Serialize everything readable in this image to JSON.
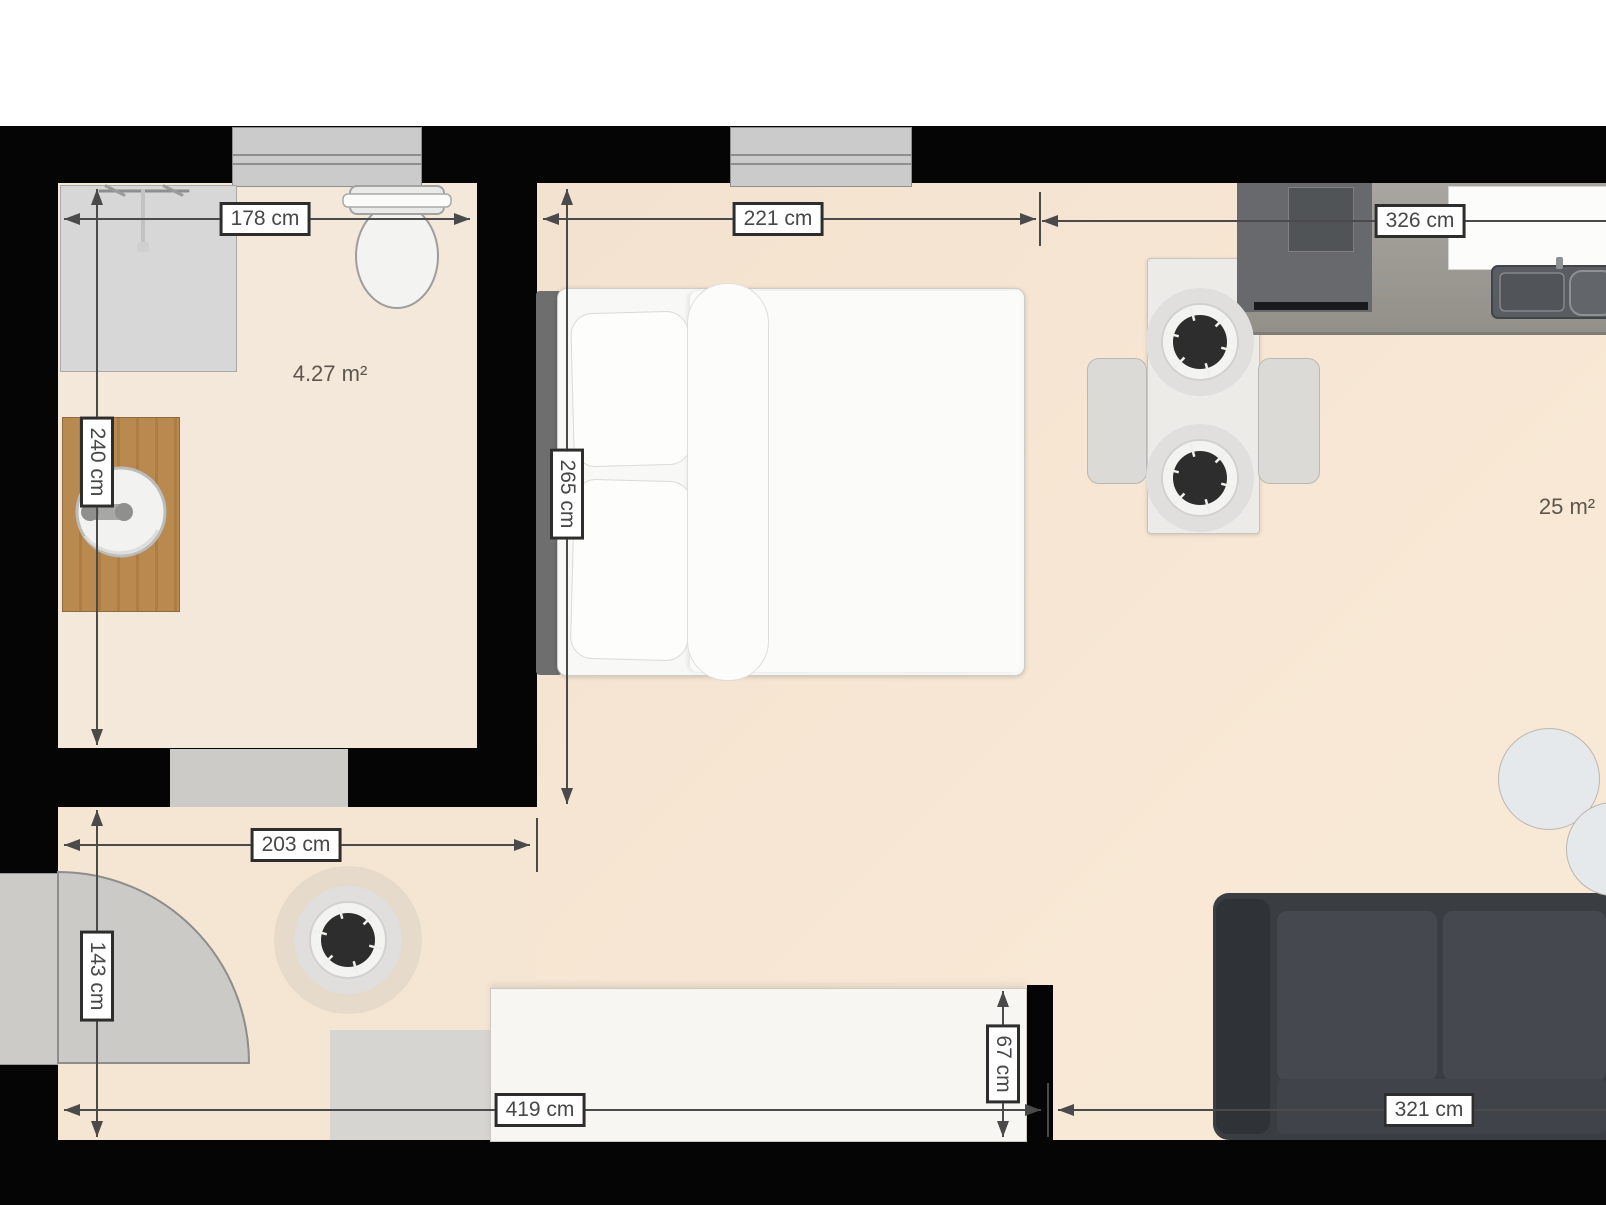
{
  "title": "Studio apartment floor plan",
  "rooms": {
    "bathroom_area": "4.27 m²",
    "main_area": "25 m²"
  },
  "dimensions": {
    "bath_width": "178 cm",
    "bed_zone_width": "221 cm",
    "kitchen_run_width": "326 cm",
    "bath_depth": "240 cm",
    "bed_zone_depth": "265 cm",
    "hall_width": "203 cm",
    "hall_depth": "143 cm",
    "bottom_run_width": "419 cm",
    "cabinet_depth": "67 cm",
    "living_zone_width": "321 cm"
  },
  "colors": {
    "wall": "#050505",
    "floor": "#f5e6d3",
    "fixture_gray": "#cbcbcb",
    "sofa": "#3a3d42",
    "vanity_wood": "#b9854e",
    "counter": "#9d9a95",
    "dimension_text": "#474747"
  }
}
